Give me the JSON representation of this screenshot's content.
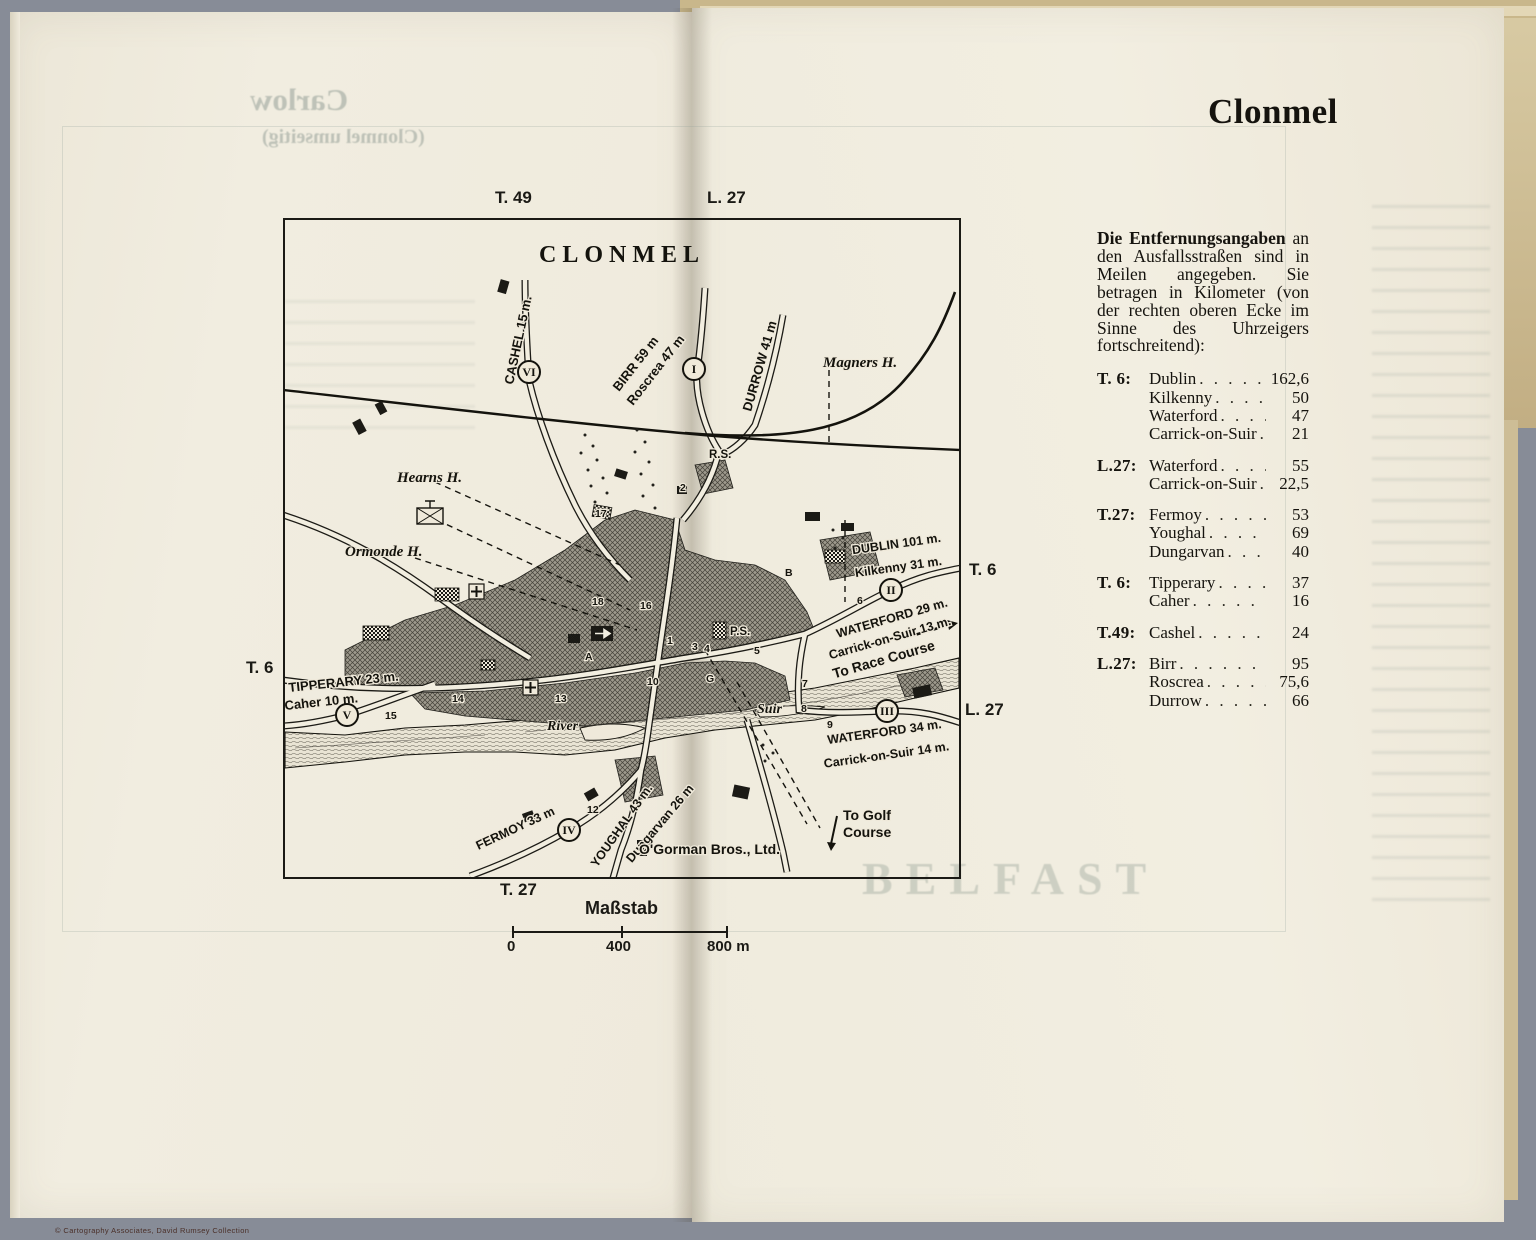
{
  "page": {
    "title": "Clonmel",
    "copyright": "© Cartography Associates, David Rumsey Collection"
  },
  "ghost": {
    "left1": "Carlow",
    "left2": "(Clonmel umseitig)",
    "right1": "BELFAST"
  },
  "map": {
    "title": "CLONMEL",
    "edge_labels": {
      "t49_top": "T. 49",
      "l27_top": "L. 27",
      "t6_right": "T. 6",
      "l27_right": "L. 27",
      "t6_left": "T. 6",
      "t27_bottom": "T. 27"
    },
    "labels": {
      "cashel": "CASHEL 15 m.",
      "birr": "BIRR 59 m",
      "roscrea": "Roscrea 47 m",
      "durrow": "DURROW 41 m",
      "magners": "Magners H.",
      "hearns": "Hearns H.",
      "ormonde": "Ormonde H.",
      "dublin": "DUBLIN 101 m.",
      "kilkenny": "Kilkenny 31 m.",
      "waterford29": "WATERFORD 29 m.",
      "carrick13": "Carrick-on-Suir 13 m.",
      "racecourse": "To Race Course",
      "tipperary": "TIPPERARY 23 m.",
      "caher": "Caher 10 m.",
      "river": "River",
      "suir": "Suir",
      "waterford34": "WATERFORD 34 m.",
      "carrick14": "Carrick-on-Suir 14 m.",
      "fermoy": "FERMOY 33 m",
      "youghal": "YOUGHAL 43 m.",
      "dungarvan": "Dungarvan 26 m",
      "ogorman": "O'Gorman Bros., Ltd.",
      "togolf1": "To Golf",
      "togolf2": "Course",
      "rs": "R.S.",
      "ps": "P.S.",
      "bA": "A",
      "bB": "B",
      "bG": "G"
    },
    "route_markers": [
      {
        "label": "I",
        "x": 409,
        "y": 149
      },
      {
        "label": "II",
        "x": 606,
        "y": 370
      },
      {
        "label": "III",
        "x": 602,
        "y": 491
      },
      {
        "label": "IV",
        "x": 284,
        "y": 610
      },
      {
        "label": "V",
        "x": 62,
        "y": 495
      },
      {
        "label": "VI",
        "x": 244,
        "y": 152
      }
    ],
    "numbers": [
      {
        "n": "1",
        "x": 382,
        "y": 424
      },
      {
        "n": "2",
        "x": 395,
        "y": 271
      },
      {
        "n": "3",
        "x": 407,
        "y": 430
      },
      {
        "n": "4",
        "x": 419,
        "y": 432
      },
      {
        "n": "5",
        "x": 469,
        "y": 434
      },
      {
        "n": "6",
        "x": 572,
        "y": 384
      },
      {
        "n": "7",
        "x": 517,
        "y": 467
      },
      {
        "n": "8",
        "x": 516,
        "y": 492
      },
      {
        "n": "9",
        "x": 542,
        "y": 508
      },
      {
        "n": "10",
        "x": 362,
        "y": 465
      },
      {
        "n": "12",
        "x": 302,
        "y": 593
      },
      {
        "n": "13",
        "x": 270,
        "y": 482
      },
      {
        "n": "14",
        "x": 167,
        "y": 482
      },
      {
        "n": "15",
        "x": 100,
        "y": 499
      },
      {
        "n": "16",
        "x": 355,
        "y": 389
      },
      {
        "n": "17",
        "x": 310,
        "y": 297
      },
      {
        "n": "18",
        "x": 307,
        "y": 385
      }
    ],
    "scale": {
      "label": "Maßstab",
      "t0": "0",
      "t400": "400",
      "t800": "800 m"
    }
  },
  "legend": {
    "heading": "Die Entfernungsangaben",
    "intro": "an den Ausfallsstraßen sind in Meilen angegeben.  Sie betragen in Kilometer (von der rechten oberen Ecke im Sinne des Uhrzeigers fortschreitend):",
    "groups": [
      {
        "route": "T. 6:",
        "entries": [
          {
            "name": "Dublin",
            "value": "162,6"
          },
          {
            "name": "Kilkenny",
            "value": "50"
          },
          {
            "name": "Waterford",
            "value": "47"
          },
          {
            "name": "Carrick-on-Suir",
            "value": "21"
          }
        ]
      },
      {
        "route": "L.27:",
        "entries": [
          {
            "name": "Waterford",
            "value": "55"
          },
          {
            "name": "Carrick-on-Suir",
            "value": "22,5"
          }
        ]
      },
      {
        "route": "T.27:",
        "entries": [
          {
            "name": "Fermoy",
            "value": "53"
          },
          {
            "name": "Youghal",
            "value": "69"
          },
          {
            "name": "Dungarvan",
            "value": "40"
          }
        ]
      },
      {
        "route": "T. 6:",
        "entries": [
          {
            "name": "Tipperary",
            "value": "37"
          },
          {
            "name": "Caher",
            "value": "16"
          }
        ]
      },
      {
        "route": "T.49:",
        "entries": [
          {
            "name": "Cashel",
            "value": "24"
          }
        ]
      },
      {
        "route": "L.27:",
        "entries": [
          {
            "name": "Birr",
            "value": "95"
          },
          {
            "name": "Roscrea",
            "value": "75,6"
          },
          {
            "name": "Durrow",
            "value": "66"
          }
        ]
      }
    ]
  }
}
